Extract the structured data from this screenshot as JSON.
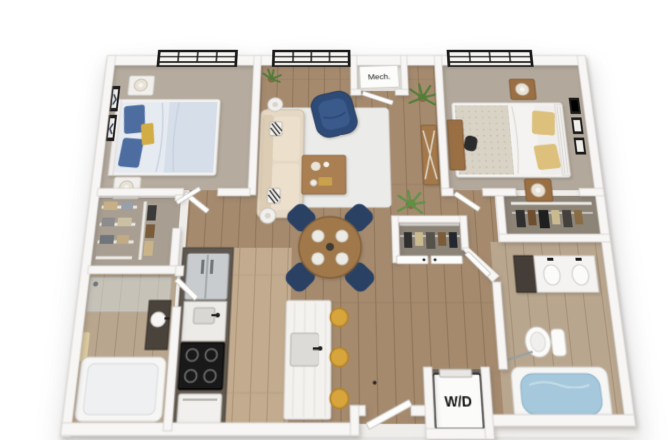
{
  "labels": {
    "mech_closet": "Mech.",
    "washer_dryer": "W/D"
  },
  "palette": {
    "background": "#ffffff",
    "wall": "#f7f6f4",
    "wall_edge": "#d6d3cf",
    "carpet_bedroom": "#b5ab9e",
    "closet_floor": "#8d8478",
    "wood_dark": "#a58a6e",
    "wood_light": "#c2ab8e",
    "rug": "#ebebe9",
    "sofa_beige": "#e5d8c4",
    "armchair_navy": "#2e4b77",
    "dining_chair_navy": "#2a4164",
    "stool_yellow": "#d7a53c",
    "pillow_blue": "#4d6da0",
    "pillow_yellow": "#d2ac44",
    "cabinet_dark": "#5f574e",
    "fridge_stainless": "#c8ccce",
    "stove_black": "#191919",
    "plant_green": "#4e7c38",
    "tub_water": "#a6c8dc",
    "window_frame": "#1b1b1b",
    "vanity_dark": "#453e37",
    "bed_frame_white": "#f3f2f0",
    "nightstand_wood": "#9a6f44"
  },
  "rooms": [
    "bedroom-left",
    "living-room",
    "bedroom-right",
    "kitchen",
    "dining-area",
    "bathroom-left",
    "bathroom-right",
    "walk-in-closet",
    "bedroom-right-closet",
    "hall-closet",
    "mechanical-closet",
    "laundry-closet",
    "entry"
  ]
}
